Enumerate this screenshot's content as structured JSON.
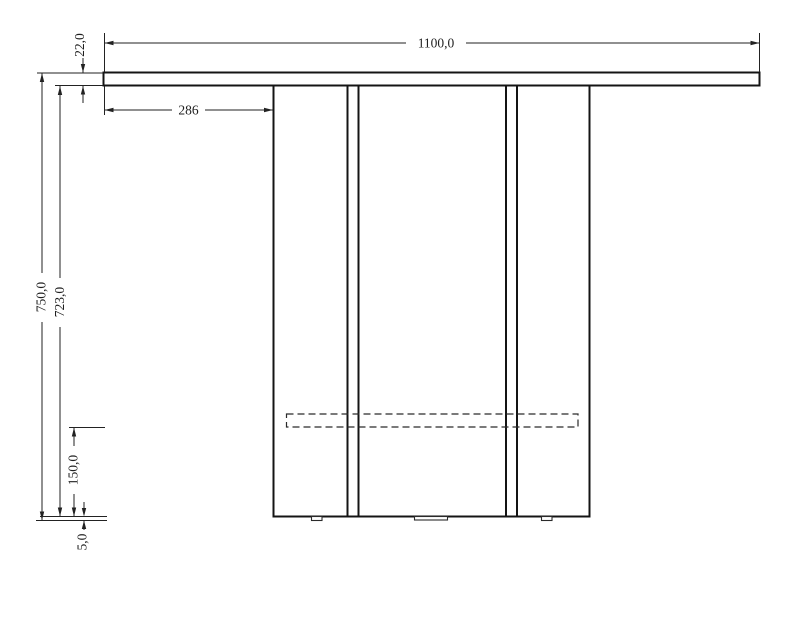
{
  "drawing": {
    "dim_tabletop_width": "1100,0",
    "dim_tabletop_thickness": "22,0",
    "dim_overhang": "286",
    "dim_overall_height": "750,0",
    "dim_base_height": "723,0",
    "dim_rail_height": "150,0",
    "dim_foot_height": "5,0"
  },
  "colors": {
    "line": "#1a1a1a",
    "background": "#ffffff"
  }
}
